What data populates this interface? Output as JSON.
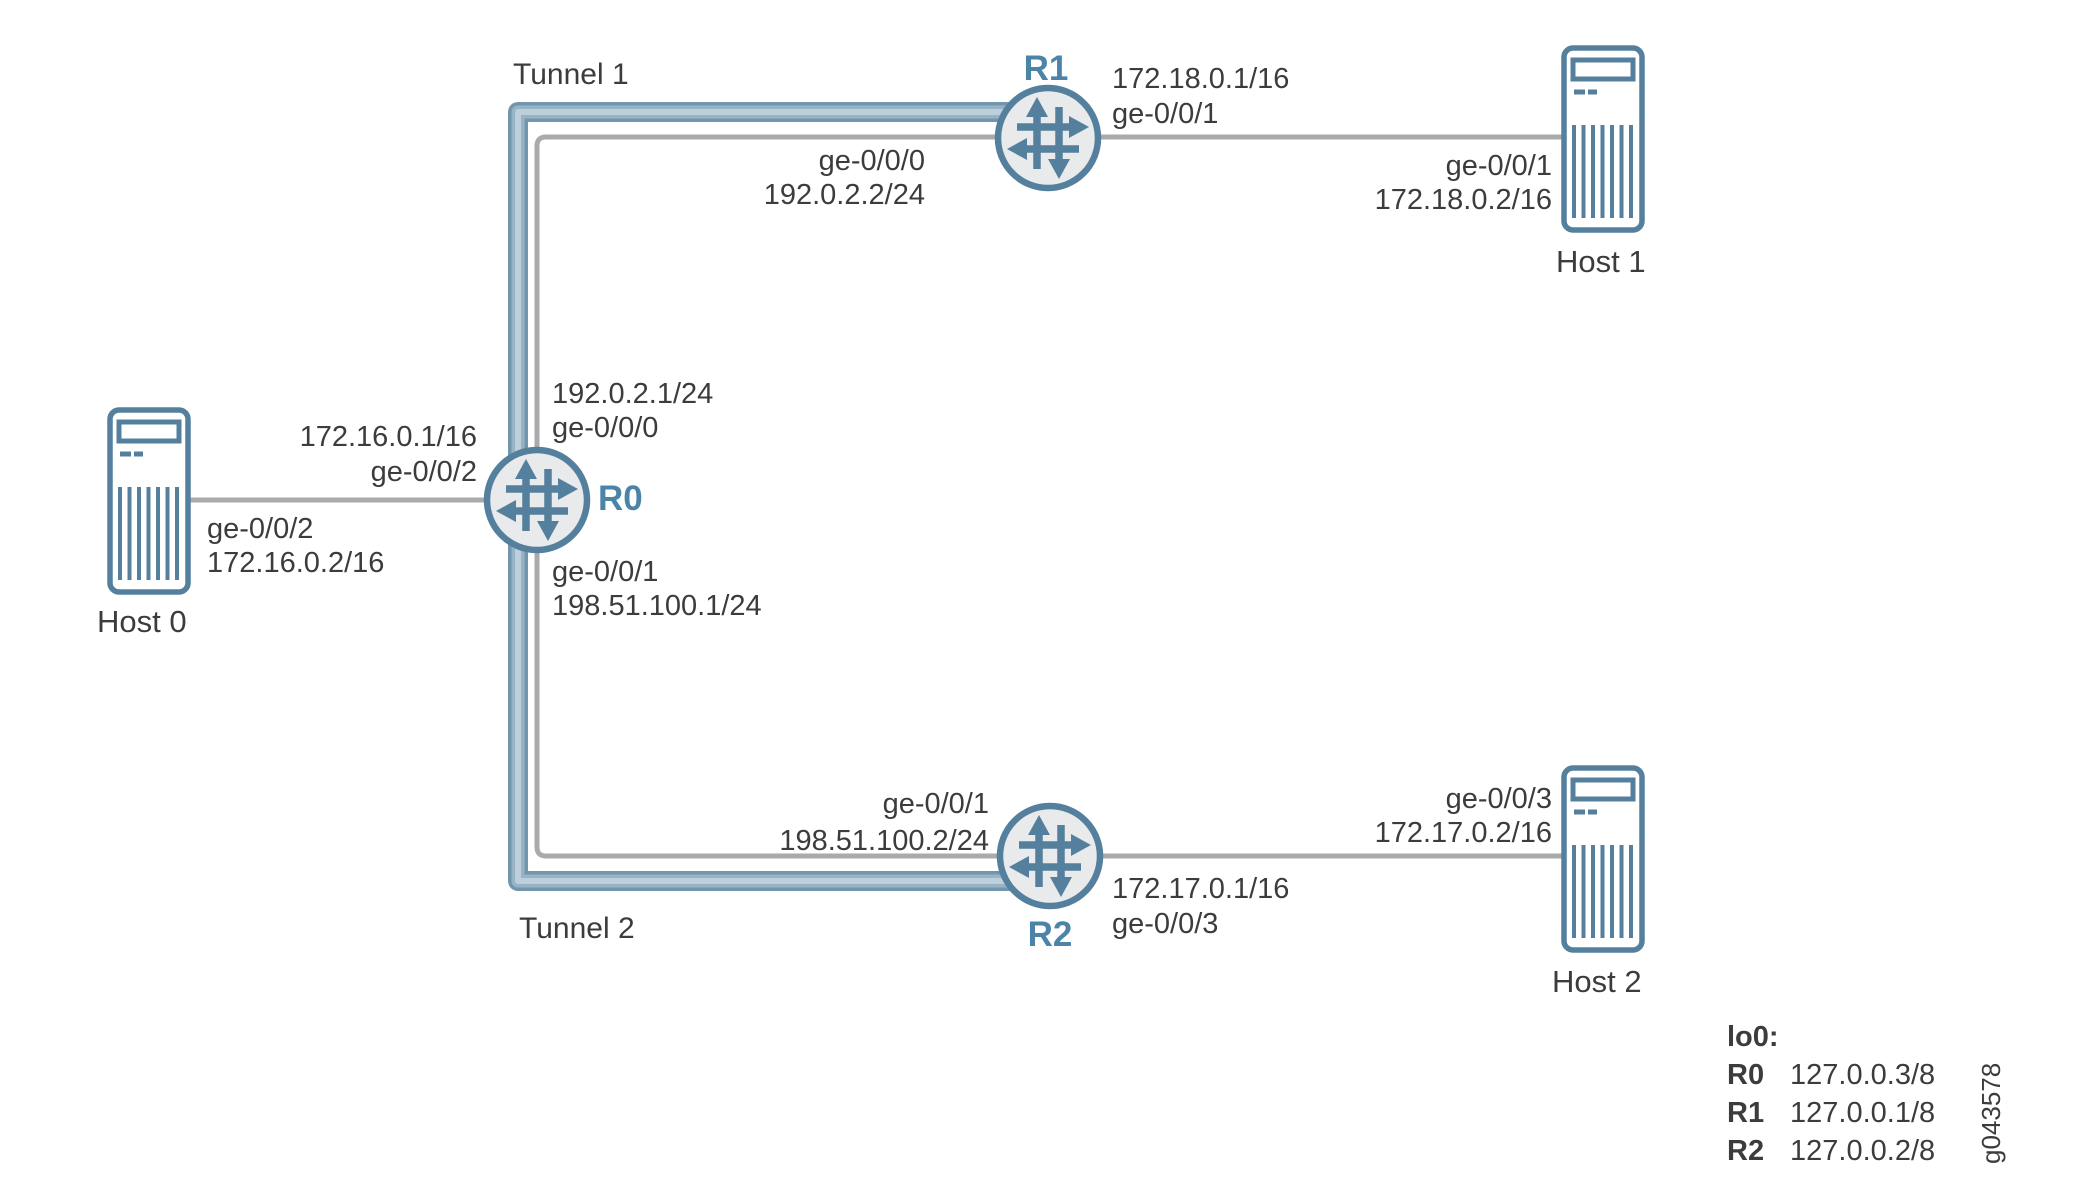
{
  "diagram": {
    "tunnel1_label": "Tunnel 1",
    "tunnel2_label": "Tunnel 2",
    "figure_id": "g043578",
    "routers": {
      "r0": {
        "name": "R0",
        "top_ip": "192.0.2.1/24",
        "top_if": "ge-0/0/0",
        "left_ip": "172.16.0.1/16",
        "left_if": "ge-0/0/2",
        "bottom_if": "ge-0/0/1",
        "bottom_ip": "198.51.100.1/24"
      },
      "r1": {
        "name": "R1",
        "right_ip": "172.18.0.1/16",
        "right_if": "ge-0/0/1",
        "left_if": "ge-0/0/0",
        "left_ip": "192.0.2.2/24"
      },
      "r2": {
        "name": "R2",
        "left_if": "ge-0/0/1",
        "left_ip": "198.51.100.2/24",
        "right_ip": "172.17.0.1/16",
        "right_if": "ge-0/0/3"
      }
    },
    "hosts": {
      "host0": {
        "name": "Host 0",
        "if": "ge-0/0/2",
        "ip": "172.16.0.2/16"
      },
      "host1": {
        "name": "Host 1",
        "if": "ge-0/0/1",
        "ip": "172.18.0.2/16"
      },
      "host2": {
        "name": "Host 2",
        "if": "ge-0/0/3",
        "ip": "172.17.0.2/16"
      }
    },
    "legend": {
      "title": "lo0:",
      "rows": [
        {
          "label": "R0",
          "value": "127.0.0.3/8"
        },
        {
          "label": "R1",
          "value": "127.0.0.1/8"
        },
        {
          "label": "R2",
          "value": "127.0.0.2/8"
        }
      ]
    },
    "icons": {
      "router": "juniper-router-icon",
      "host": "server-tower-icon"
    }
  },
  "colors": {
    "steel_blue": "#54809e",
    "label_blue": "#4c84a8",
    "node_fill": "#e8eaeb",
    "link_gray": "#a8aaac",
    "tunnel_outer": "#7396ad",
    "tunnel_mid": "#97b4c6",
    "tunnel_core": "#bccfda",
    "text_dark": "#3c3c3e",
    "canvas_bg": "#ffffff"
  }
}
